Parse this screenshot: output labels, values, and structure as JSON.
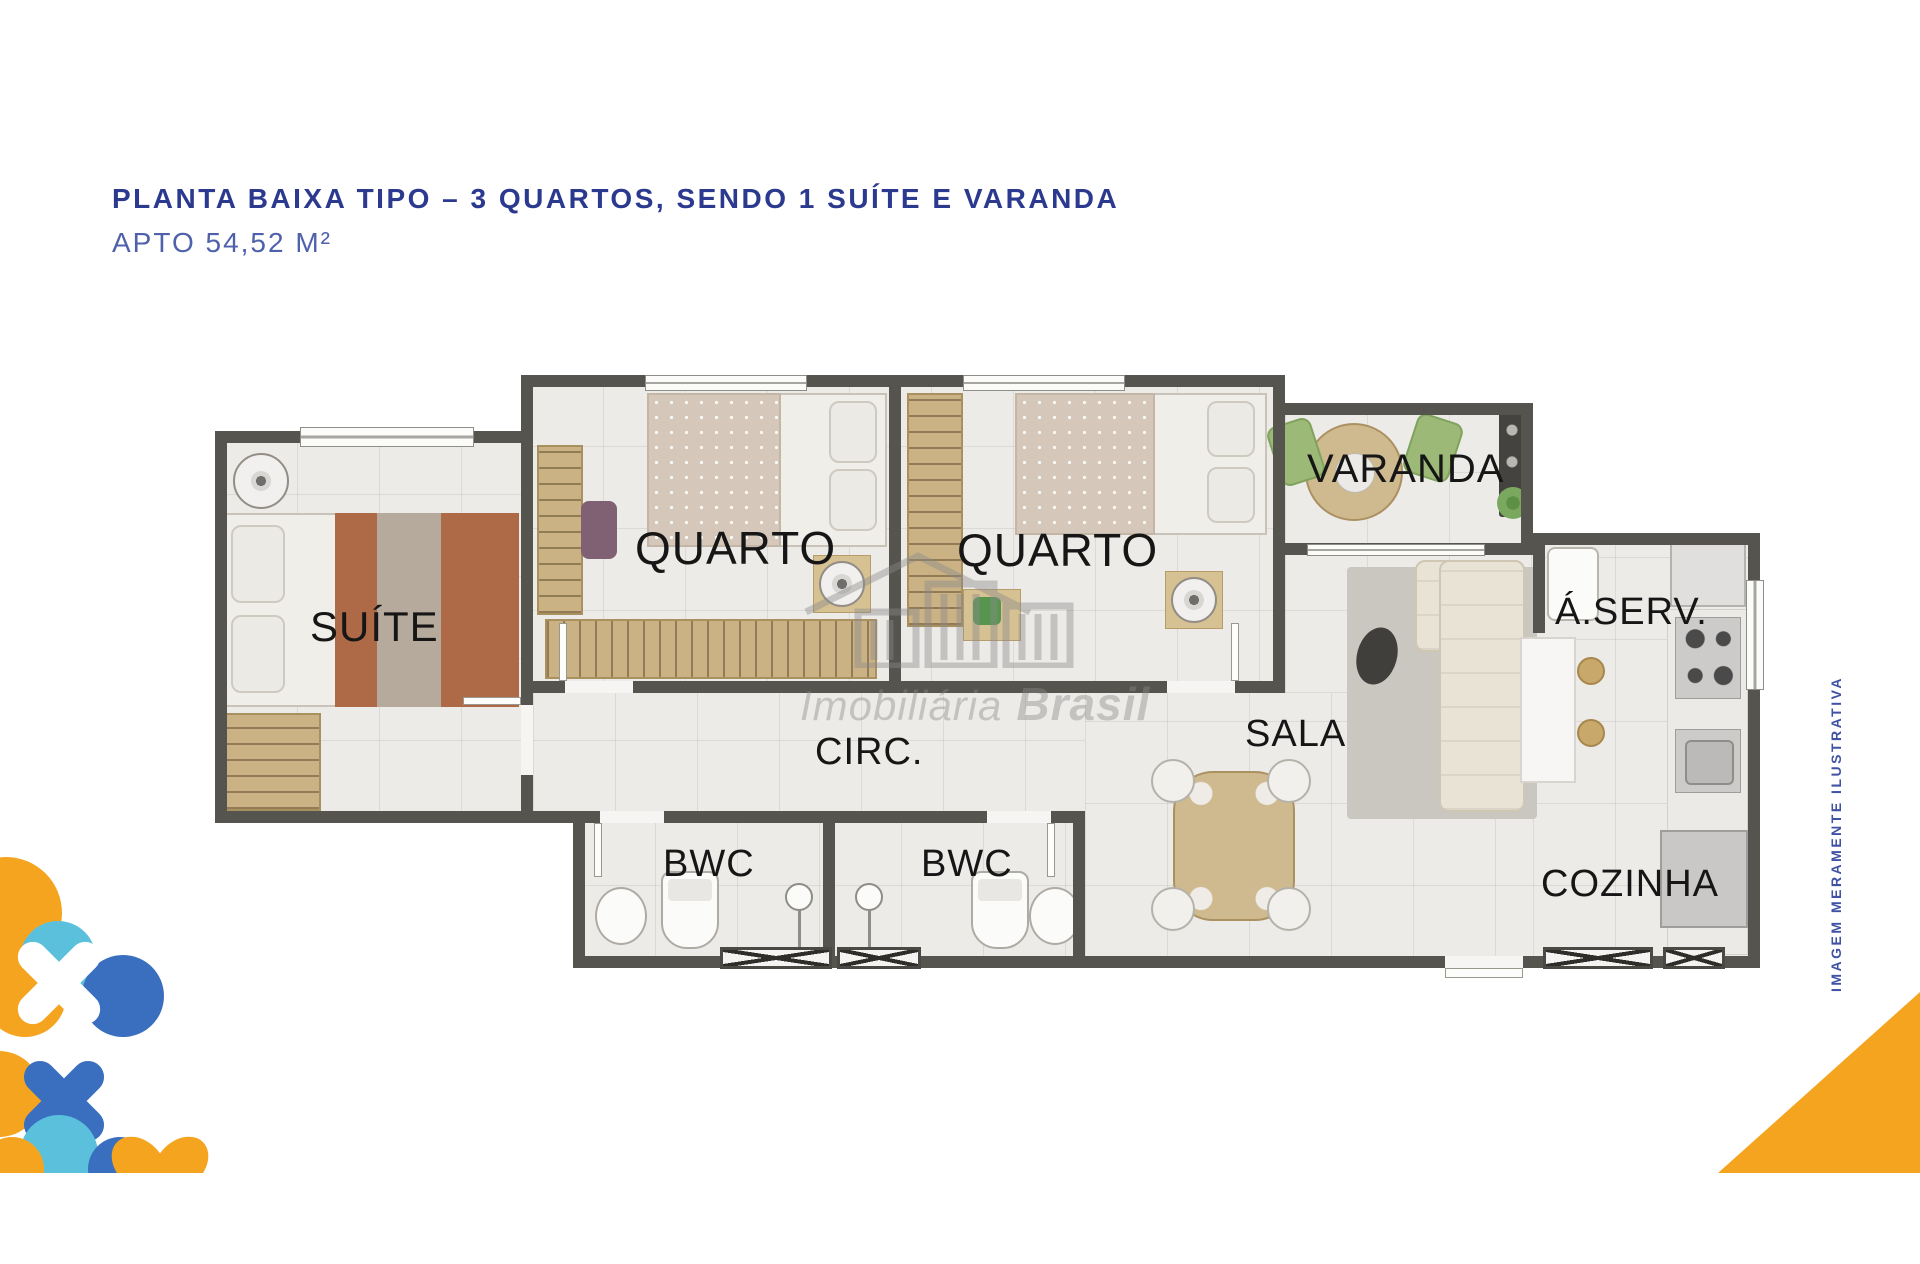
{
  "header": {
    "title": "PLANTA BAIXA TIPO – 3 QUARTOS, SENDO 1 SUÍTE E VARANDA",
    "subtitle": "APTO 54,52 M²"
  },
  "floorplan": {
    "rooms": [
      {
        "id": "suite",
        "label": "SUÍTE"
      },
      {
        "id": "quarto1",
        "label": "QUARTO"
      },
      {
        "id": "quarto2",
        "label": "QUARTO"
      },
      {
        "id": "varanda",
        "label": "VARANDA"
      },
      {
        "id": "circ",
        "label": "CIRC."
      },
      {
        "id": "sala",
        "label": "SALA"
      },
      {
        "id": "bwc1",
        "label": "BWC"
      },
      {
        "id": "bwc2",
        "label": "BWC"
      },
      {
        "id": "aserv",
        "label": "Á.SERV."
      },
      {
        "id": "cozinha",
        "label": "COZINHA"
      }
    ]
  },
  "watermark": {
    "line1": "Imobiliária",
    "line2": "Brasil"
  },
  "side_note": "IMAGEM MERAMENTE ILUSTRATIVA",
  "colors": {
    "title_blue": "#2b3a8f",
    "subtitle_blue": "#4f61ab",
    "note_blue": "#4053a3",
    "wall": "#56544e",
    "floor": "#edebe8",
    "wood": "#cbb285",
    "accent_orange": "#f5a41f",
    "accent_light_blue": "#5bc0dc",
    "accent_blue": "#3a6fc0"
  },
  "icons": [
    "ceiling-fan-icon",
    "shower-icon",
    "toilet-icon",
    "sink-icon",
    "cooktop-icon",
    "fridge-icon",
    "washer-icon",
    "grill-icon",
    "plant-icon",
    "window-icon",
    "door-icon"
  ]
}
